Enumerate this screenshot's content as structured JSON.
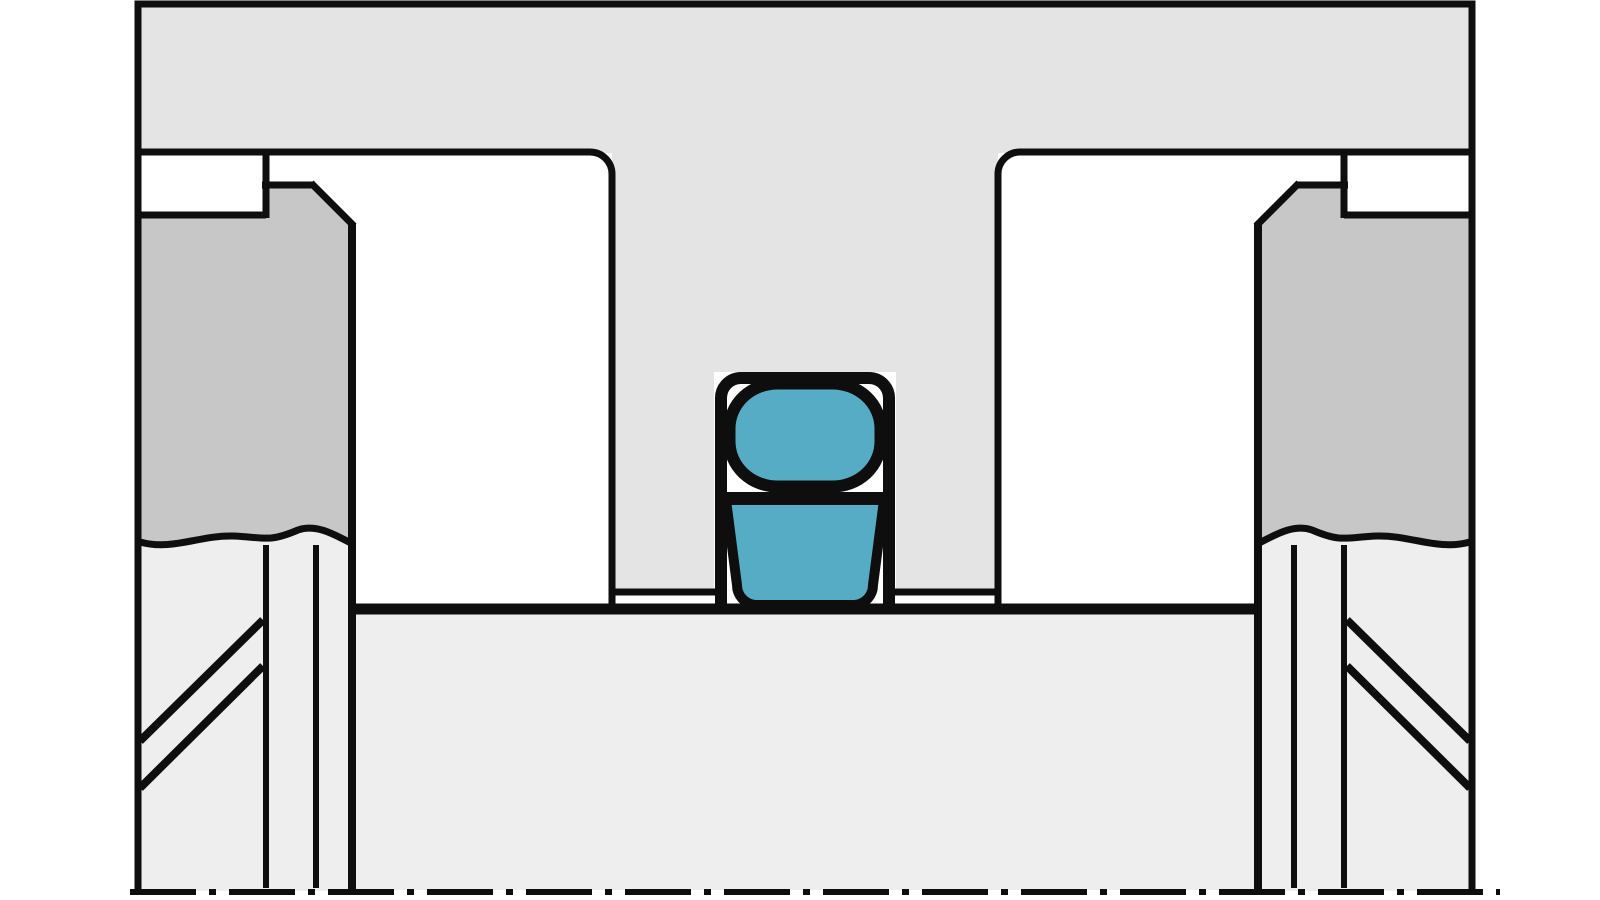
{
  "diagram": {
    "type": "technical-cross-section",
    "colors": {
      "background": "#ffffff",
      "housing_fill": "#e4e4e4",
      "gland_fill": "#c7c7c7",
      "rod_fill": "#eeeeee",
      "seal_fill": "#55acc4",
      "outline": "#0e0e0e"
    },
    "parts": {
      "housing": "upper-housing-block",
      "gland_left": "left-gland-block",
      "gland_right": "right-gland-block",
      "tongue": "central-groove-tongue",
      "groove": "seal-groove-cavity",
      "o_ring": "o-ring-cross-section",
      "backup_ring": "back-up-ring-cross-section",
      "rod": "lower-rod-surface",
      "centerline": "dash-dot-centerline",
      "break_lines": "wavy-break-lines"
    }
  }
}
